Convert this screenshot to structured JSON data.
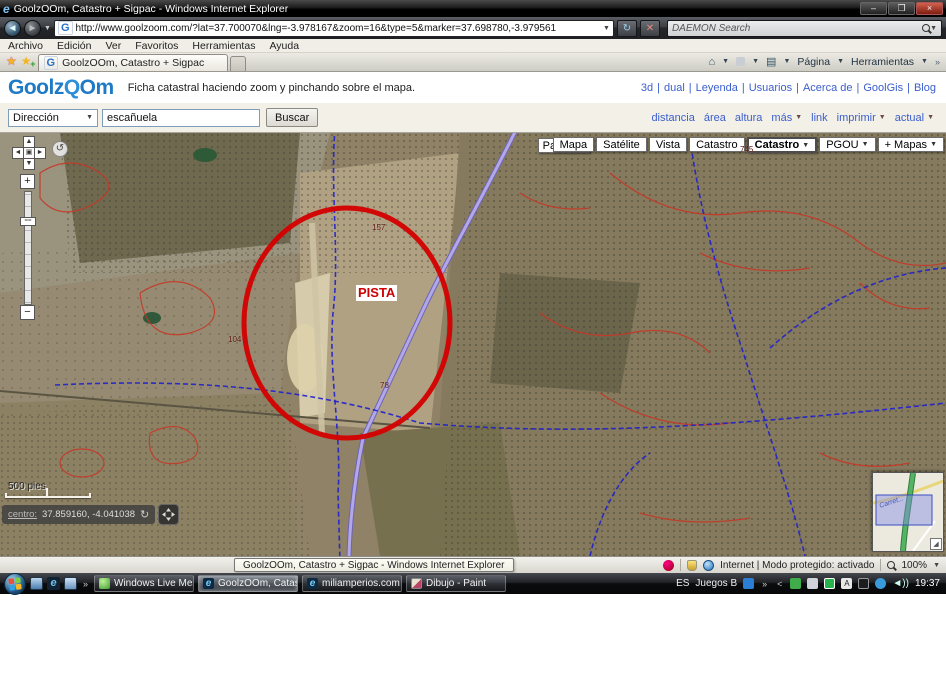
{
  "window": {
    "title": "GoolzOOm, Catastro + Sigpac - Windows Internet Explorer"
  },
  "address": {
    "url": "http://www.goolzoom.com/?lat=37.700070&lng=-3.978167&zoom=16&type=5&marker=37.698780,-3.979561",
    "search_placeholder": "DAEMON Search"
  },
  "menu": {
    "items": [
      "Archivo",
      "Edición",
      "Ver",
      "Favoritos",
      "Herramientas",
      "Ayuda"
    ]
  },
  "tabs": {
    "active": "GoolzOOm, Catastro + Sigpac"
  },
  "command_bar": {
    "page": "Página",
    "tools": "Herramientas"
  },
  "site": {
    "logo": {
      "part1": "Goolz",
      "part2": "Q",
      "part3": "Om"
    },
    "tagline": "Ficha catastral haciendo zoom y pinchando sobre el mapa.",
    "links": [
      "3d",
      "dual",
      "Leyenda",
      "Usuarios",
      "Acerca de",
      "GoolGis",
      "Blog"
    ]
  },
  "search": {
    "category": "Dirección",
    "query": "escañuela",
    "button": "Buscar",
    "tools": [
      "distancia",
      "área",
      "altura",
      "más",
      "link",
      "imprimir",
      "actual"
    ]
  },
  "map": {
    "parcelas": "Parcelas",
    "buttons": [
      "Mapa",
      "Satélite",
      "Vista",
      "Catastro",
      "Catastro",
      "PGOU",
      "+ Mapas"
    ],
    "annotation": "PISTA",
    "parcel_labels": [
      "104",
      "78",
      "157",
      "745"
    ],
    "scale": "500 pies",
    "center_label": "centro:",
    "center_coords": "37.859160, -4.041038",
    "overview_label": "Carret..."
  },
  "status": {
    "tooltip": "GoolzOOm, Catastro + Sigpac - Windows Internet Explorer",
    "zone": "Internet | Modo protegido: activado",
    "zoom": "100%"
  },
  "taskbar": {
    "tasks": [
      "Windows Live Mess...",
      "GoolzOOm, Catastr...",
      "miliamperios.com ::...",
      "Dibujo - Paint"
    ],
    "tray_lang": "ES",
    "tray_games": "Juegos B",
    "time": "19:37"
  }
}
